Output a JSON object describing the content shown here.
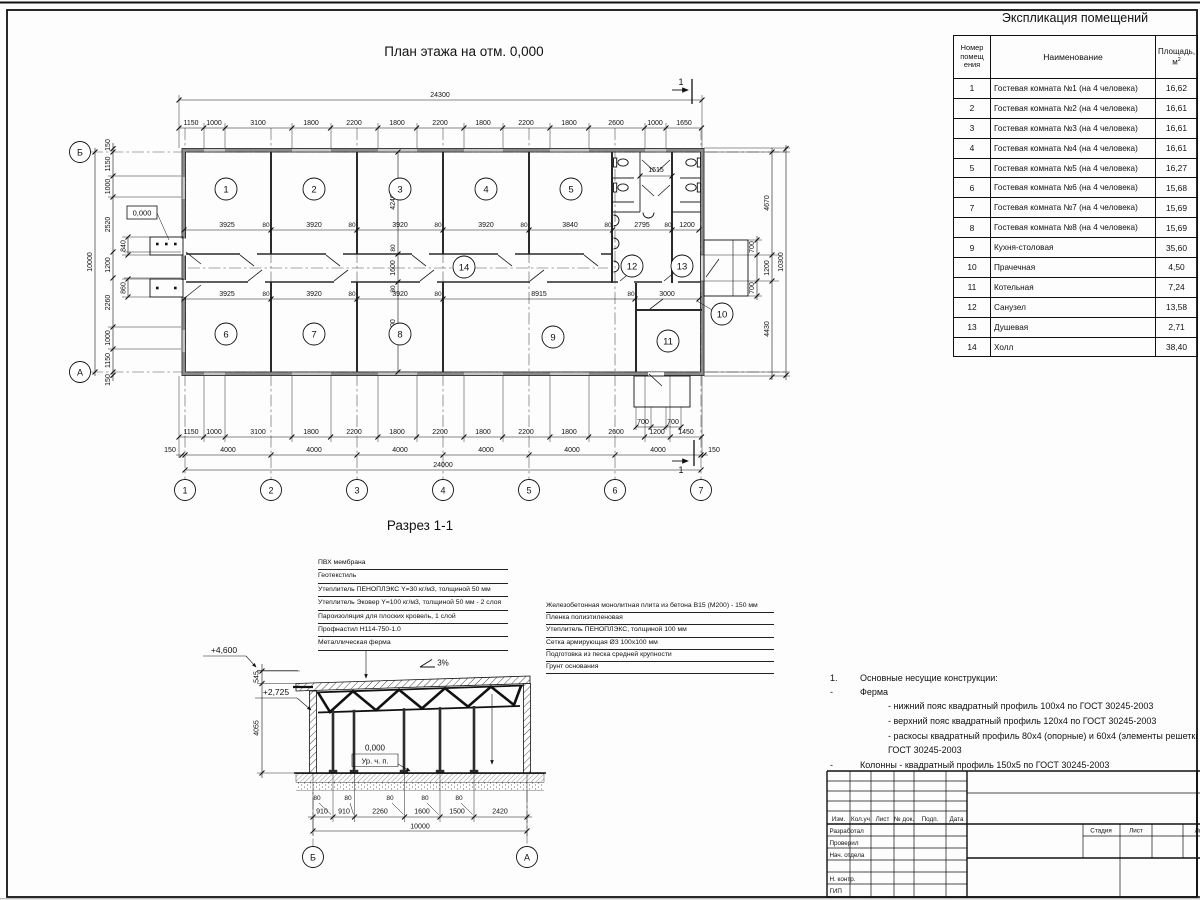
{
  "explication": {
    "title": "Экспликация помещений",
    "header": {
      "num_lines": [
        "Номер",
        "помещ",
        "ения"
      ],
      "name": "Наименование",
      "area_top": "Площадь,",
      "area_unit": "м",
      "area_sup": "2"
    },
    "rows": [
      {
        "n": "1",
        "name": "Гостевая комната №1 (на 4 человека)",
        "area": "16,62"
      },
      {
        "n": "2",
        "name": "Гостевая комната №2 (на 4 человека)",
        "area": "16,61"
      },
      {
        "n": "3",
        "name": "Гостевая комната №3 (на 4 человека)",
        "area": "16,61"
      },
      {
        "n": "4",
        "name": "Гостевая комната №4 (на 4 человека)",
        "area": "16,61"
      },
      {
        "n": "5",
        "name": "Гостевая комната №5 (на 4 человека)",
        "area": "16,27"
      },
      {
        "n": "6",
        "name": "Гостевая комната №6 (на 4 человека)",
        "area": "15,68"
      },
      {
        "n": "7",
        "name": "Гостевая комната №7 (на 4 человека)",
        "area": "15,69"
      },
      {
        "n": "8",
        "name": "Гостевая комната №8 (на 4 человека)",
        "area": "15,69"
      },
      {
        "n": "9",
        "name": "Кухня-столовая",
        "area": "35,60"
      },
      {
        "n": "10",
        "name": "Прачечная",
        "area": "4,50"
      },
      {
        "n": "11",
        "name": "Котельная",
        "area": "7,24"
      },
      {
        "n": "12",
        "name": "Санузел",
        "area": "13,58"
      },
      {
        "n": "13",
        "name": "Душевая",
        "area": "2,71"
      },
      {
        "n": "14",
        "name": "Холл",
        "area": "38,40"
      }
    ]
  },
  "plan": {
    "title": "План этажа на отм. 0,000",
    "overall_top": "24300",
    "overall_bottom": "24000",
    "chain_top": [
      "1150",
      "1000",
      "3100",
      "1800",
      "2200",
      "1800",
      "2200",
      "1800",
      "2200",
      "1800",
      "2600",
      "1000",
      "1650"
    ],
    "chain_bottom": [
      "1150",
      "1000",
      "3100",
      "1800",
      "2200",
      "1800",
      "2200",
      "1800",
      "2200",
      "1800",
      "2600",
      "1200",
      "1450"
    ],
    "axis_spacing": [
      "150",
      "4000",
      "4000",
      "4000",
      "4000",
      "4000",
      "4000",
      "150"
    ],
    "left_chain": [
      "150",
      "1150",
      "1000",
      "2520",
      "1200",
      "2260",
      "1000",
      "1150",
      "150"
    ],
    "left_inner": [
      "840",
      "860"
    ],
    "left_overall": "10000",
    "right_chain": [
      "4670",
      "1200",
      "4430"
    ],
    "right_porch": [
      "700",
      "700"
    ],
    "right_overall": "10300",
    "interior_top": [
      "3925",
      "80",
      "3920",
      "80",
      "3920",
      "80",
      "3920",
      "80",
      "3840",
      "80",
      "2795",
      "80",
      "1200"
    ],
    "interior_bottom": [
      "3925",
      "80",
      "3920",
      "80",
      "3920",
      "80",
      "8915",
      "80",
      "3000"
    ],
    "vert_dims": [
      "4240",
      "80",
      "1600",
      "80",
      "4000"
    ],
    "bath_dim": "1515",
    "porch_bottom": [
      "700",
      "700"
    ],
    "elevation_label": "0,000",
    "cols": [
      "1",
      "2",
      "3",
      "4",
      "5",
      "6",
      "7"
    ],
    "row_axes": [
      "Б",
      "А"
    ],
    "rooms": [
      "1",
      "2",
      "3",
      "4",
      "5",
      "6",
      "7",
      "8",
      "9",
      "10",
      "11",
      "12",
      "13",
      "14"
    ],
    "section_mark": "1"
  },
  "section": {
    "title": "Разрез 1-1",
    "roof_layers": [
      "ПВХ мембрана",
      "Геотекстиль",
      "Утеплитель ПЕНОПЛЭКС Y=30 кг/м3, толщиной 50 мм",
      "Утеплитель Эковер Y=100 кг/м3, толщиной 50 мм - 2 слоя",
      "Пароизоляция для плоских кровель, 1 слой",
      "Профнастил Н114-750-1.0",
      "Металлическая ферма"
    ],
    "floor_layers": [
      "Железобетонная монолитная плита из бетона В15 (М200) - 150 мм",
      "Пленка полиэтиленовая",
      "Утеплитель ПЕНОПЛЭКС, толщиной 100 мм",
      "Сетка армирующая Ø3 100х100 мм",
      "Подготовка из песка средней крупности",
      "Грунт основания"
    ],
    "elev_top": "+4,600",
    "elev_truss": "+2,725",
    "elev_floor": "0,000",
    "floor_level_label": "Ур. ч. п.",
    "slope_label": "3%",
    "dim_left": [
      "545",
      "4055"
    ],
    "col_widths": [
      "80",
      "80",
      "80",
      "80",
      "80"
    ],
    "chain_bottom": [
      "910",
      "910",
      "2260",
      "1600",
      "1500",
      "2420"
    ],
    "overall": "10000",
    "axes": [
      "Б",
      "А"
    ]
  },
  "notes": {
    "n1": "1.",
    "t1": "Основные несущие конструкции:",
    "dash": "-",
    "ferma": "Ферма",
    "sub1": "- нижний пояс квадратный профиль 100х4 по ГОСТ 30245-2003",
    "sub2": "- верхний пояс квадратный профиль 120х4 по ГОСТ 30245-2003",
    "sub3": "- раскосы квадратный профиль 80х4 (опорные) и 60х4 (элементы решетки) по",
    "sub3b": "ГОСТ 30245-2003",
    "kolonny": "Колонны - квадратный профиль 150х5 по ГОСТ 30245-2003"
  },
  "titleblock": {
    "c1": "Изм.",
    "c2": "Кол.уч",
    "c3": "Лист",
    "c4": "№ док.",
    "c5": "Подп.",
    "c6": "Дата",
    "r1": "Разработал",
    "r2": "Проверил",
    "r3": "Нач. отдела",
    "r4": "Н. контр.",
    "r5": "ГИП",
    "s1": "Стадия",
    "s2": "Лист",
    "s3": "Листов"
  }
}
